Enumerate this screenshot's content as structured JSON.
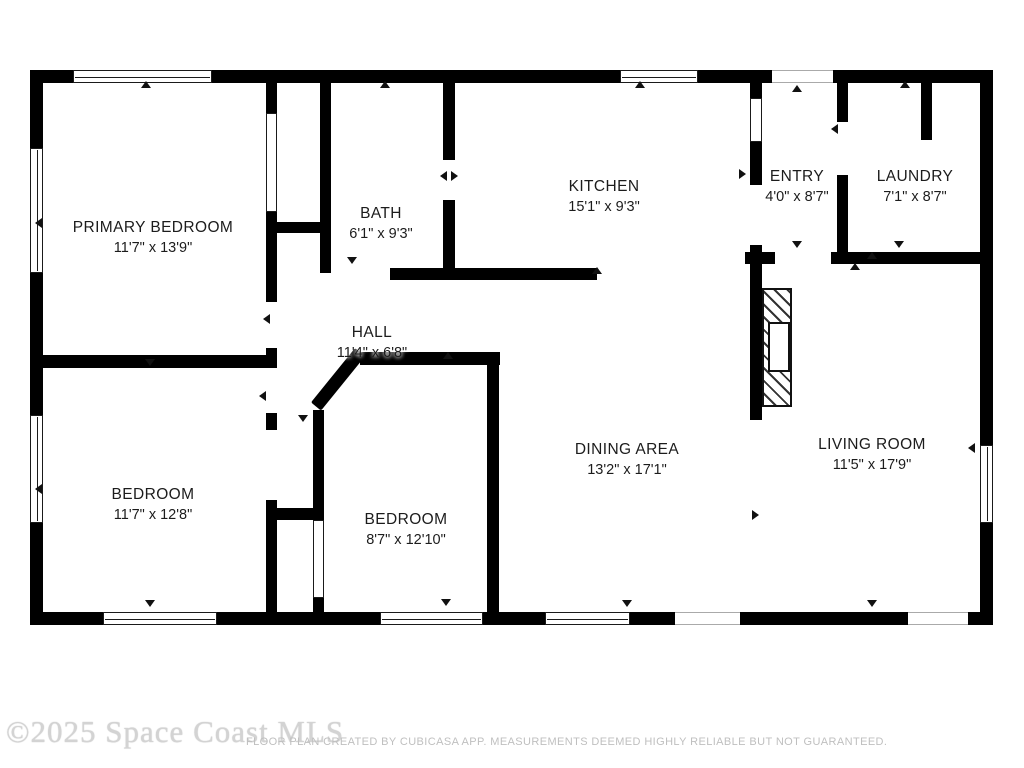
{
  "footer": {
    "watermark": "©2025 Space Coast MLS",
    "disclaimer": "FLOOR PLAN CREATED BY CUBICASA APP. MEASUREMENTS DEEMED HIGHLY RELIABLE BUT NOT GUARANTEED."
  },
  "colors": {
    "wall": "#000000",
    "background": "#ffffff",
    "label_text": "#1c1c1c",
    "watermark_text": "#d3d3d3",
    "disclaimer_text": "#bfbfbf"
  },
  "rooms": [
    {
      "id": "primary-bedroom",
      "name": "PRIMARY BEDROOM",
      "dims": "11'7\" x 13'9\"",
      "cx": 153,
      "cy": 238
    },
    {
      "id": "bath",
      "name": "BATH",
      "dims": "6'1\" x 9'3\"",
      "cx": 381,
      "cy": 224
    },
    {
      "id": "kitchen",
      "name": "KITCHEN",
      "dims": "15'1\" x 9'3\"",
      "cx": 604,
      "cy": 197
    },
    {
      "id": "entry",
      "name": "ENTRY",
      "dims": "4'0\" x 8'7\"",
      "cx": 797,
      "cy": 187
    },
    {
      "id": "laundry",
      "name": "LAUNDRY",
      "dims": "7'1\" x 8'7\"",
      "cx": 915,
      "cy": 187
    },
    {
      "id": "hall",
      "name": "HALL",
      "dims": "11'4\" x 6'8\"",
      "cx": 372,
      "cy": 343
    },
    {
      "id": "bedroom-left",
      "name": "BEDROOM",
      "dims": "11'7\" x 12'8\"",
      "cx": 153,
      "cy": 505
    },
    {
      "id": "bedroom-middle",
      "name": "BEDROOM",
      "dims": "8'7\" x 12'10\"",
      "cx": 406,
      "cy": 530
    },
    {
      "id": "dining-area",
      "name": "DINING AREA",
      "dims": "13'2\" x 17'1\"",
      "cx": 627,
      "cy": 460
    },
    {
      "id": "living-room",
      "name": "LIVING ROOM",
      "dims": "11'5\" x 17'9\"",
      "cx": 872,
      "cy": 455
    }
  ],
  "plan": {
    "walls": [
      {
        "id": "ext-top-1",
        "x": 30,
        "y": 70,
        "w": 43,
        "h": 13
      },
      {
        "id": "ext-top-2",
        "x": 212,
        "y": 70,
        "w": 408,
        "h": 13
      },
      {
        "id": "ext-top-3",
        "x": 698,
        "y": 70,
        "w": 74,
        "h": 13
      },
      {
        "id": "ext-top-4",
        "x": 833,
        "y": 70,
        "w": 160,
        "h": 13
      },
      {
        "id": "ext-left-1",
        "x": 30,
        "y": 70,
        "w": 13,
        "h": 78
      },
      {
        "id": "ext-left-2",
        "x": 30,
        "y": 273,
        "w": 13,
        "h": 142
      },
      {
        "id": "ext-left-3",
        "x": 30,
        "y": 523,
        "w": 13,
        "h": 102
      },
      {
        "id": "ext-right-1",
        "x": 980,
        "y": 70,
        "w": 13,
        "h": 375
      },
      {
        "id": "ext-right-2",
        "x": 980,
        "y": 523,
        "w": 13,
        "h": 102
      },
      {
        "id": "ext-bottom-1",
        "x": 30,
        "y": 612,
        "w": 73,
        "h": 13
      },
      {
        "id": "ext-bottom-2",
        "x": 217,
        "y": 612,
        "w": 163,
        "h": 13
      },
      {
        "id": "ext-bottom-3",
        "x": 483,
        "y": 612,
        "w": 62,
        "h": 13
      },
      {
        "id": "ext-bottom-4",
        "x": 630,
        "y": 612,
        "w": 45,
        "h": 13
      },
      {
        "id": "ext-bottom-5",
        "x": 740,
        "y": 612,
        "w": 168,
        "h": 13
      },
      {
        "id": "ext-bottom-6",
        "x": 968,
        "y": 612,
        "w": 25,
        "h": 13
      },
      {
        "id": "primary-right-top",
        "x": 266,
        "y": 82,
        "w": 11,
        "h": 31
      },
      {
        "id": "primary-right-mid",
        "x": 266,
        "y": 212,
        "w": 11,
        "h": 90
      },
      {
        "id": "primary-right-low",
        "x": 266,
        "y": 348,
        "w": 11,
        "h": 20
      },
      {
        "id": "primary-bottom",
        "x": 30,
        "y": 355,
        "w": 247,
        "h": 13
      },
      {
        "id": "closet-top-divider",
        "x": 266,
        "y": 222,
        "w": 65,
        "h": 11
      },
      {
        "id": "bath-left",
        "x": 320,
        "y": 82,
        "w": 11,
        "h": 191
      },
      {
        "id": "bath-right-top",
        "x": 443,
        "y": 82,
        "w": 12,
        "h": 78
      },
      {
        "id": "bath-right-bottom",
        "x": 443,
        "y": 200,
        "w": 12,
        "h": 80
      },
      {
        "id": "bath-kitchen-bottom",
        "x": 390,
        "y": 268,
        "w": 207,
        "h": 12
      },
      {
        "id": "entry-left-top",
        "x": 750,
        "y": 82,
        "w": 12,
        "h": 16
      },
      {
        "id": "entry-left-mid",
        "x": 750,
        "y": 142,
        "w": 12,
        "h": 43
      },
      {
        "id": "entry-left-low",
        "x": 750,
        "y": 245,
        "w": 12,
        "h": 19
      },
      {
        "id": "entry-laundry-wall-top",
        "x": 837,
        "y": 82,
        "w": 11,
        "h": 40
      },
      {
        "id": "entry-laundry-wall-low",
        "x": 837,
        "y": 175,
        "w": 11,
        "h": 89
      },
      {
        "id": "laundry-stub",
        "x": 921,
        "y": 82,
        "w": 11,
        "h": 58
      },
      {
        "id": "entry-bottom-left",
        "x": 745,
        "y": 252,
        "w": 30,
        "h": 12
      },
      {
        "id": "laundry-bottom",
        "x": 831,
        "y": 252,
        "w": 162,
        "h": 12
      },
      {
        "id": "living-west",
        "x": 750,
        "y": 264,
        "w": 12,
        "h": 156
      },
      {
        "id": "bedroom2-top",
        "x": 360,
        "y": 352,
        "w": 140,
        "h": 13
      },
      {
        "id": "bedroom2-right",
        "x": 487,
        "y": 352,
        "w": 12,
        "h": 261
      },
      {
        "id": "bedroom2-left",
        "x": 313,
        "y": 410,
        "w": 11,
        "h": 110
      },
      {
        "id": "bedroom2-left-stub",
        "x": 313,
        "y": 598,
        "w": 11,
        "h": 15
      },
      {
        "id": "bedroom1-right-top",
        "x": 266,
        "y": 413,
        "w": 11,
        "h": 17
      },
      {
        "id": "bedroom1-right-low",
        "x": 266,
        "y": 500,
        "w": 11,
        "h": 113
      },
      {
        "id": "closet-bottom-divider",
        "x": 266,
        "y": 508,
        "w": 58,
        "h": 12
      }
    ],
    "diagonal": {
      "id": "hall-diagonal",
      "x": 316,
      "y": 400,
      "len": 70,
      "h": 13,
      "angle": -51
    },
    "windows": [
      {
        "id": "win-top-primary",
        "x": 73,
        "y": 70,
        "w": 139,
        "h": 13
      },
      {
        "id": "win-top-kitchen",
        "x": 620,
        "y": 70,
        "w": 78,
        "h": 13
      },
      {
        "id": "win-left-primary",
        "x": 30,
        "y": 148,
        "w": 13,
        "h": 125
      },
      {
        "id": "win-left-bedroom1",
        "x": 30,
        "y": 415,
        "w": 13,
        "h": 108
      },
      {
        "id": "win-right-living",
        "x": 980,
        "y": 445,
        "w": 13,
        "h": 78
      },
      {
        "id": "win-bottom-bedroom1",
        "x": 103,
        "y": 612,
        "w": 114,
        "h": 13
      },
      {
        "id": "win-bottom-bedroom2",
        "x": 380,
        "y": 612,
        "w": 103,
        "h": 13
      },
      {
        "id": "win-bottom-dining",
        "x": 545,
        "y": 612,
        "w": 85,
        "h": 13
      }
    ],
    "openings": [
      {
        "id": "front-door-opening",
        "x": 772,
        "y": 70,
        "w": 61,
        "h": 13
      },
      {
        "id": "dining-slider-opening",
        "x": 675,
        "y": 612,
        "w": 65,
        "h": 13
      },
      {
        "id": "living-slider-opening",
        "x": 908,
        "y": 612,
        "w": 60,
        "h": 13
      }
    ],
    "panel_doors": [
      {
        "id": "primary-closet-doors",
        "x": 266,
        "y": 113,
        "w": 11,
        "h": 99
      },
      {
        "id": "bedroom2-closet-doors",
        "x": 313,
        "y": 520,
        "w": 11,
        "h": 78
      },
      {
        "id": "kitchen-entry-pocket-door",
        "x": 750,
        "y": 98,
        "w": 12,
        "h": 44
      }
    ],
    "fireplace": {
      "id": "fireplace",
      "x": 762,
      "y": 288,
      "w": 30,
      "h": 119,
      "firebox": {
        "x": 768,
        "y": 322,
        "w": 22,
        "h": 50
      }
    },
    "markers": [
      {
        "x": 146,
        "y": 85,
        "dir": "up"
      },
      {
        "x": 385,
        "y": 85,
        "dir": "up"
      },
      {
        "x": 640,
        "y": 85,
        "dir": "up"
      },
      {
        "x": 797,
        "y": 89,
        "dir": "up"
      },
      {
        "x": 905,
        "y": 85,
        "dir": "up"
      },
      {
        "x": 872,
        "y": 256,
        "dir": "up"
      },
      {
        "x": 448,
        "y": 356,
        "dir": "up"
      },
      {
        "x": 597,
        "y": 271,
        "dir": "up"
      },
      {
        "x": 855,
        "y": 267,
        "dir": "up"
      },
      {
        "x": 150,
        "y": 363,
        "dir": "down"
      },
      {
        "x": 352,
        "y": 261,
        "dir": "down"
      },
      {
        "x": 797,
        "y": 245,
        "dir": "down"
      },
      {
        "x": 899,
        "y": 245,
        "dir": "down"
      },
      {
        "x": 150,
        "y": 604,
        "dir": "down"
      },
      {
        "x": 446,
        "y": 603,
        "dir": "down"
      },
      {
        "x": 627,
        "y": 604,
        "dir": "down"
      },
      {
        "x": 872,
        "y": 604,
        "dir": "down"
      },
      {
        "x": 303,
        "y": 419,
        "dir": "down"
      },
      {
        "x": 40,
        "y": 222,
        "dir": "left"
      },
      {
        "x": 40,
        "y": 488,
        "dir": "left"
      },
      {
        "x": 268,
        "y": 318,
        "dir": "left"
      },
      {
        "x": 264,
        "y": 395,
        "dir": "left"
      },
      {
        "x": 973,
        "y": 447,
        "dir": "left"
      },
      {
        "x": 445,
        "y": 175,
        "dir": "left"
      },
      {
        "x": 836,
        "y": 128,
        "dir": "left"
      },
      {
        "x": 757,
        "y": 514,
        "dir": "right"
      },
      {
        "x": 456,
        "y": 175,
        "dir": "right"
      },
      {
        "x": 744,
        "y": 173,
        "dir": "right"
      }
    ]
  }
}
